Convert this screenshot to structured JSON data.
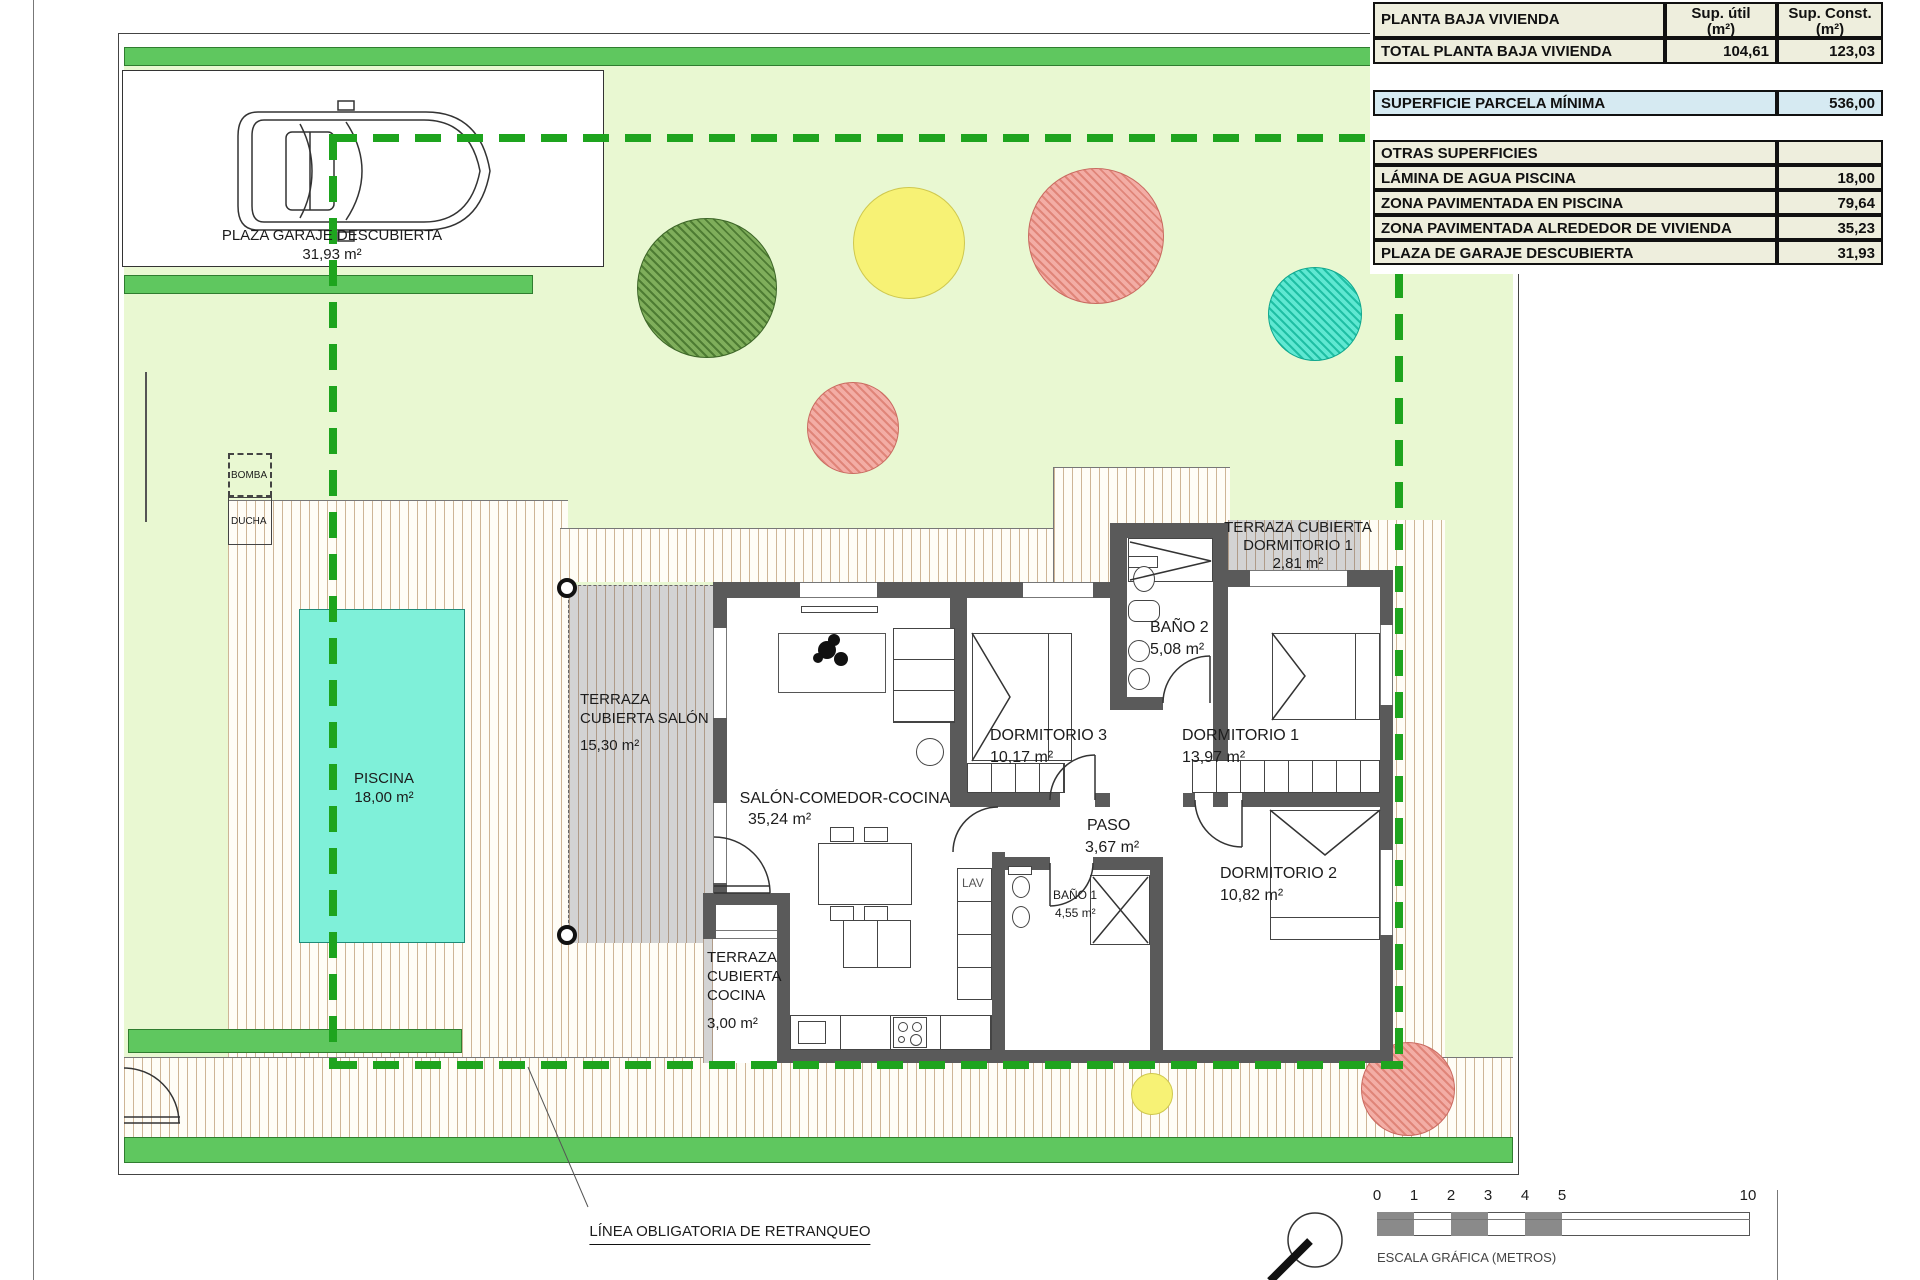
{
  "plan": {
    "garage": {
      "label": "PLAZA GARAJE DESCUBIERTA",
      "area": "31,93 m²"
    },
    "bomba": {
      "label": "BOMBA"
    },
    "ducha": {
      "label": "DUCHA"
    },
    "pool": {
      "label": "PISCINA",
      "area": "18,00 m²"
    },
    "terraza_salon": {
      "label": "TERRAZA CUBIERTA SALÓN",
      "area": "15,30 m²"
    },
    "salon": {
      "label": "SALÓN-COMEDOR-COCINA",
      "area": "35,24 m²"
    },
    "dorm3": {
      "label": "DORMITORIO 3",
      "area": "10,17 m²"
    },
    "bano2": {
      "label": "BAÑO 2",
      "area": "5,08 m²"
    },
    "dorm1": {
      "label": "DORMITORIO 1",
      "area": "13,97 m²"
    },
    "terraza_dorm1": {
      "label": "TERRAZA CUBIERTA DORMITORIO 1",
      "area": "2,81 m²"
    },
    "paso": {
      "label": "PASO",
      "area": "3,67 m²"
    },
    "bano1": {
      "label": "BAÑO 1",
      "area": "4,55 m²"
    },
    "lav": {
      "label": "LAV"
    },
    "dorm2": {
      "label": "DORMITORIO 2",
      "area": "10,82 m²"
    },
    "terraza_cocina": {
      "label": "TERRAZA CUBIERTA COCINA",
      "area": "3,00 m²"
    },
    "setback_line": {
      "label": "LÍNEA OBLIGATORIA DE RETRANQUEO"
    }
  },
  "table": {
    "header": {
      "room": "PLANTA BAJA VIVIENDA",
      "util1": "Sup. útil",
      "util2": "(m²)",
      "const1": "Sup. Const.",
      "const2": "(m²)"
    },
    "total_row": {
      "label": "TOTAL PLANTA BAJA VIVIENDA",
      "util": "104,61",
      "const": "123,03"
    },
    "parcela_row": {
      "label": "SUPERFICIE PARCELA MÍNIMA",
      "value": "536,00"
    },
    "otras_header": "OTRAS SUPERFICIES",
    "otras_rows": [
      {
        "label": "LÁMINA DE AGUA PISCINA",
        "value": "18,00"
      },
      {
        "label": "ZONA PAVIMENTADA EN PISCINA",
        "value": "79,64"
      },
      {
        "label": "ZONA PAVIMENTADA ALREDEDOR DE VIVIENDA",
        "value": "35,23"
      },
      {
        "label": "PLAZA DE GARAJE DESCUBIERTA",
        "value": "31,93"
      }
    ]
  },
  "scale_bar": {
    "ticks": [
      "0",
      "1",
      "2",
      "3",
      "4",
      "5",
      "10"
    ],
    "caption": "ESCALA GRÁFICA (METROS)"
  },
  "colors": {
    "hedge": "#5fc75f",
    "garden": "#e9f8d2",
    "pool": "#7ff0d9",
    "setback": "#1ea41e",
    "table_highlight": "#d6eaf2"
  }
}
